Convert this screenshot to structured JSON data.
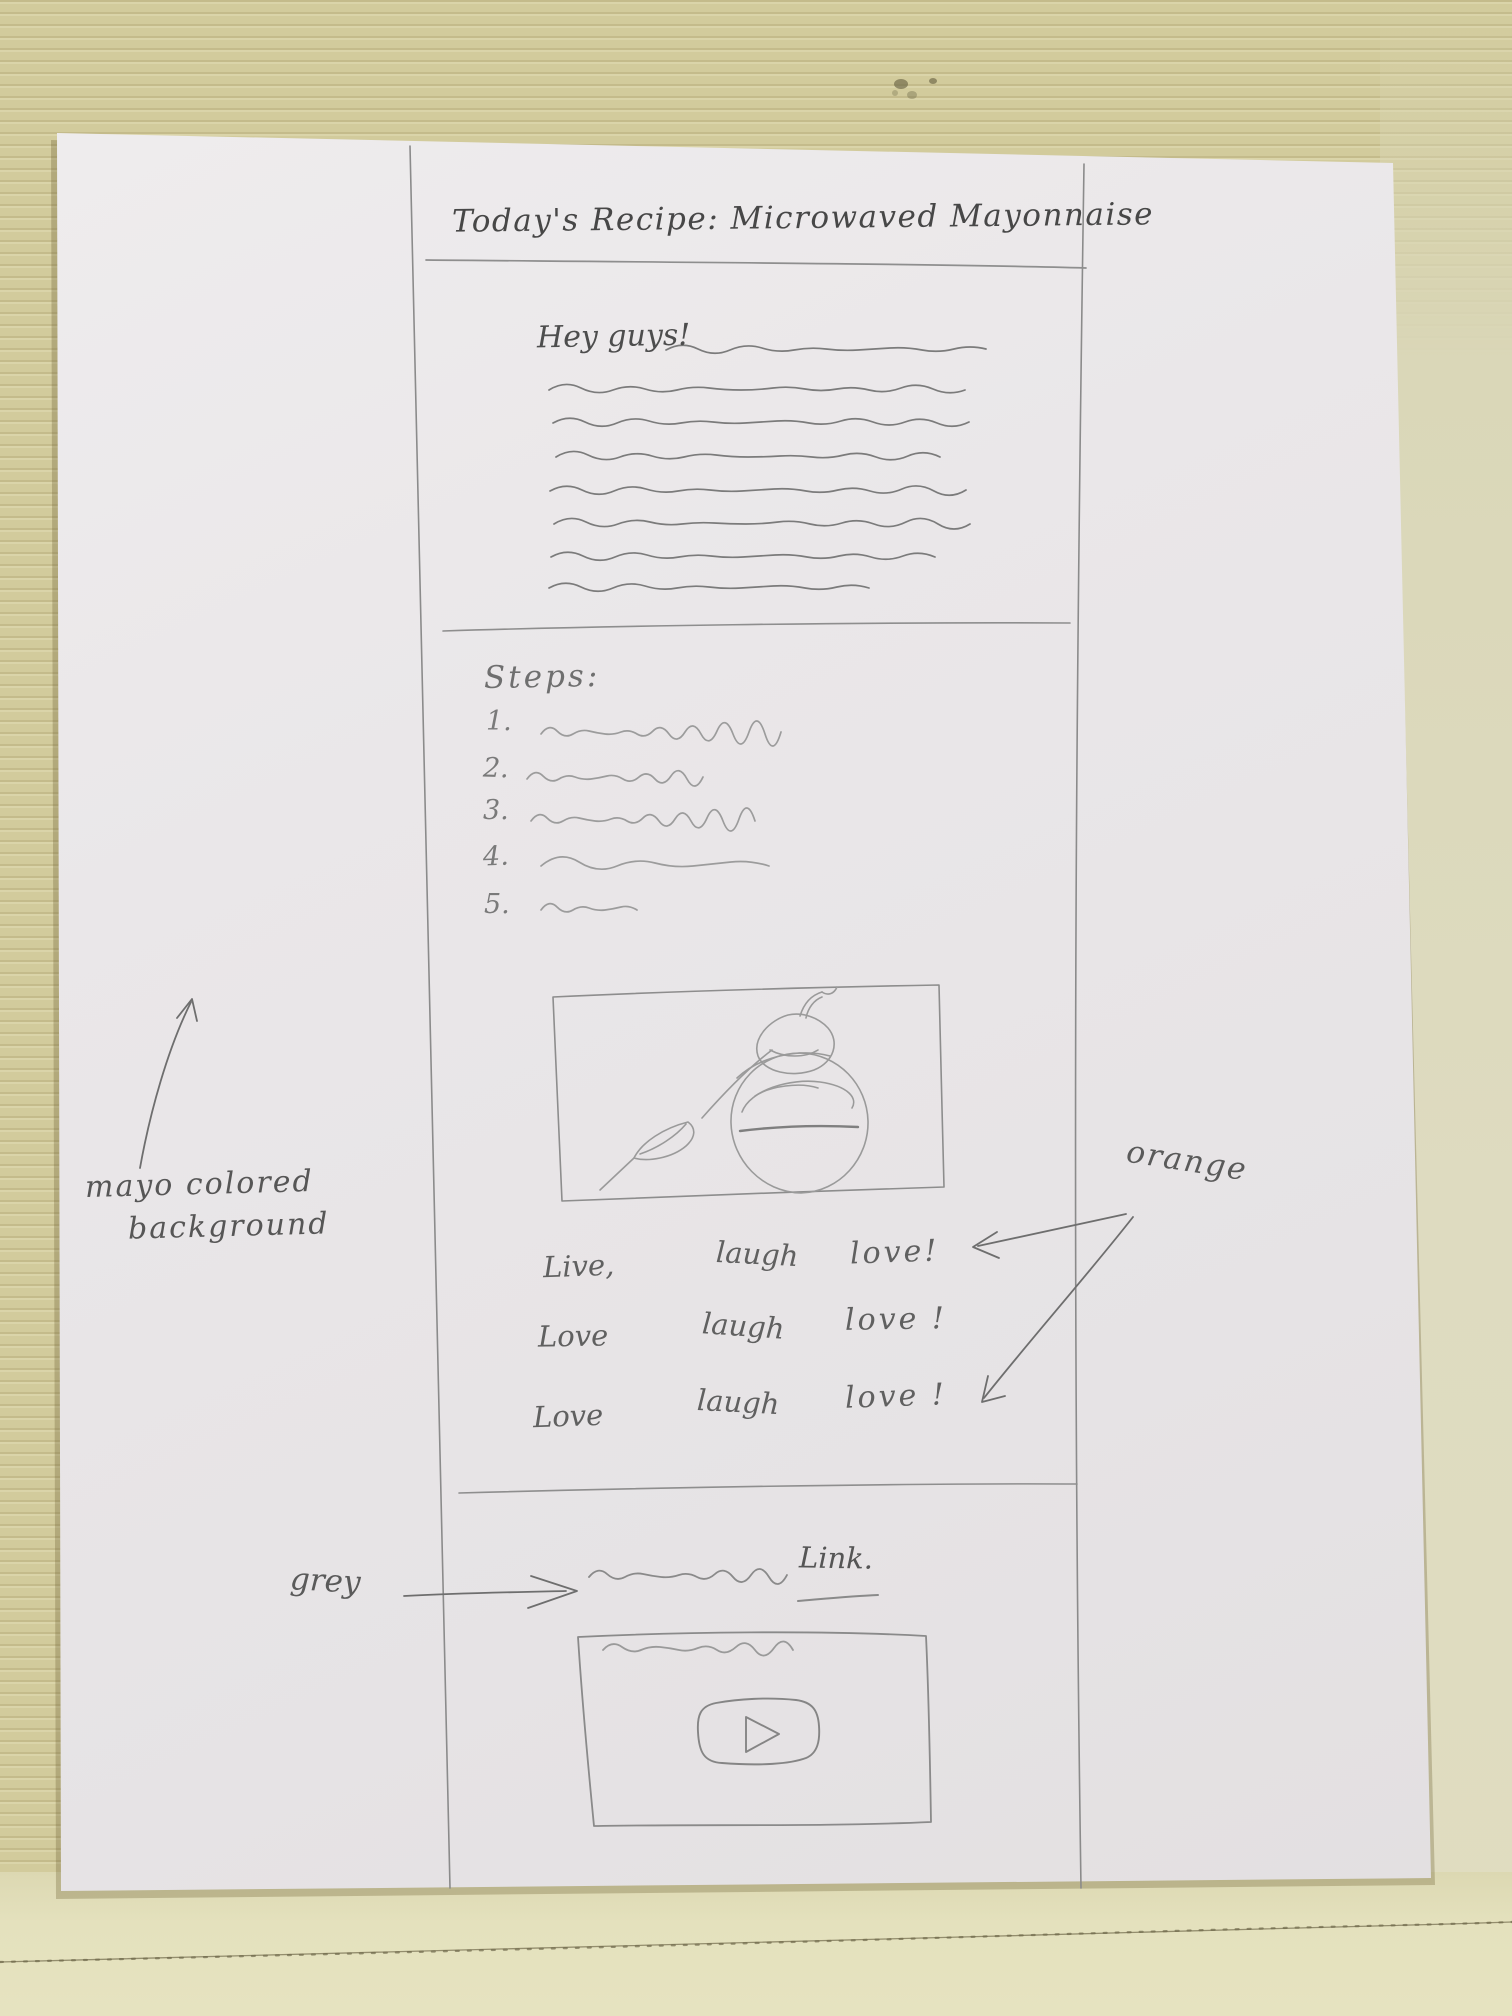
{
  "colors": {
    "cardboard": "#d2cb9c",
    "cardboard_light": "#e4e1bd",
    "paper": "#eae7e8",
    "pencil": "#6a6a6a"
  },
  "sketch": {
    "title": "Today's Recipe: Microwaved Mayonnaise",
    "greeting": "Hey guys!",
    "steps": {
      "heading": "Steps:",
      "numbers": [
        "1.",
        "2.",
        "3.",
        "4.",
        "5."
      ]
    },
    "slogans": [
      [
        "Live,",
        "laugh",
        "love!"
      ],
      [
        "Love",
        "laugh",
        "love !"
      ],
      [
        "Love",
        "laugh",
        "love !"
      ]
    ],
    "link_label": "Link.",
    "annotations": {
      "orange": "orange",
      "grey": "grey",
      "mayo_line1": "mayo colored",
      "mayo_line2": "background"
    }
  }
}
